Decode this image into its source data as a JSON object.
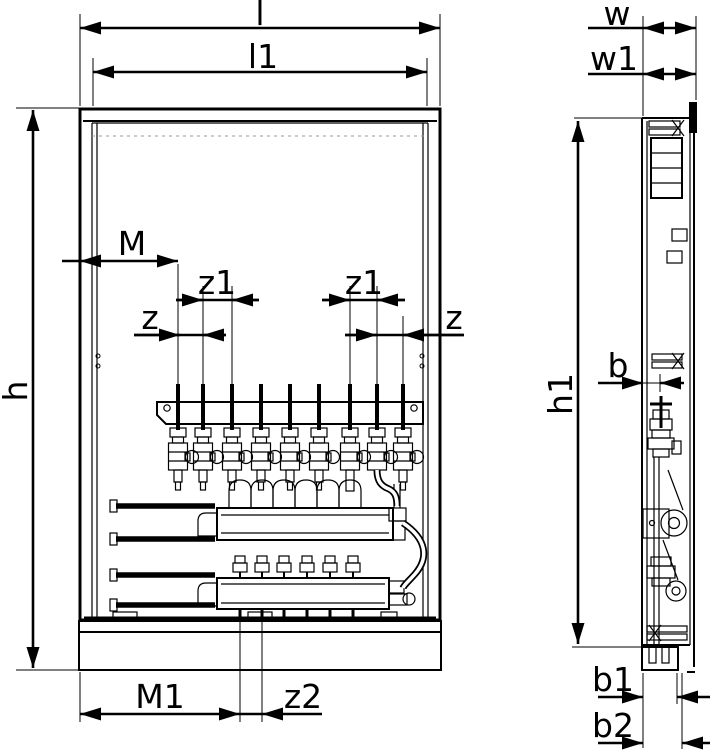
{
  "diagram": {
    "dimensions": {
      "l": "l",
      "l1": "l1",
      "w": "w",
      "w1": "w1",
      "h": "h",
      "h1": "h1",
      "M": "M",
      "M1": "M1",
      "z": "z",
      "z1": "z1",
      "z2": "z2",
      "b": "b",
      "b1": "b1",
      "b2": "b2"
    },
    "colors": {
      "line": "#000000",
      "background": "#ffffff",
      "hidden_line": "#9a9a9a"
    }
  }
}
